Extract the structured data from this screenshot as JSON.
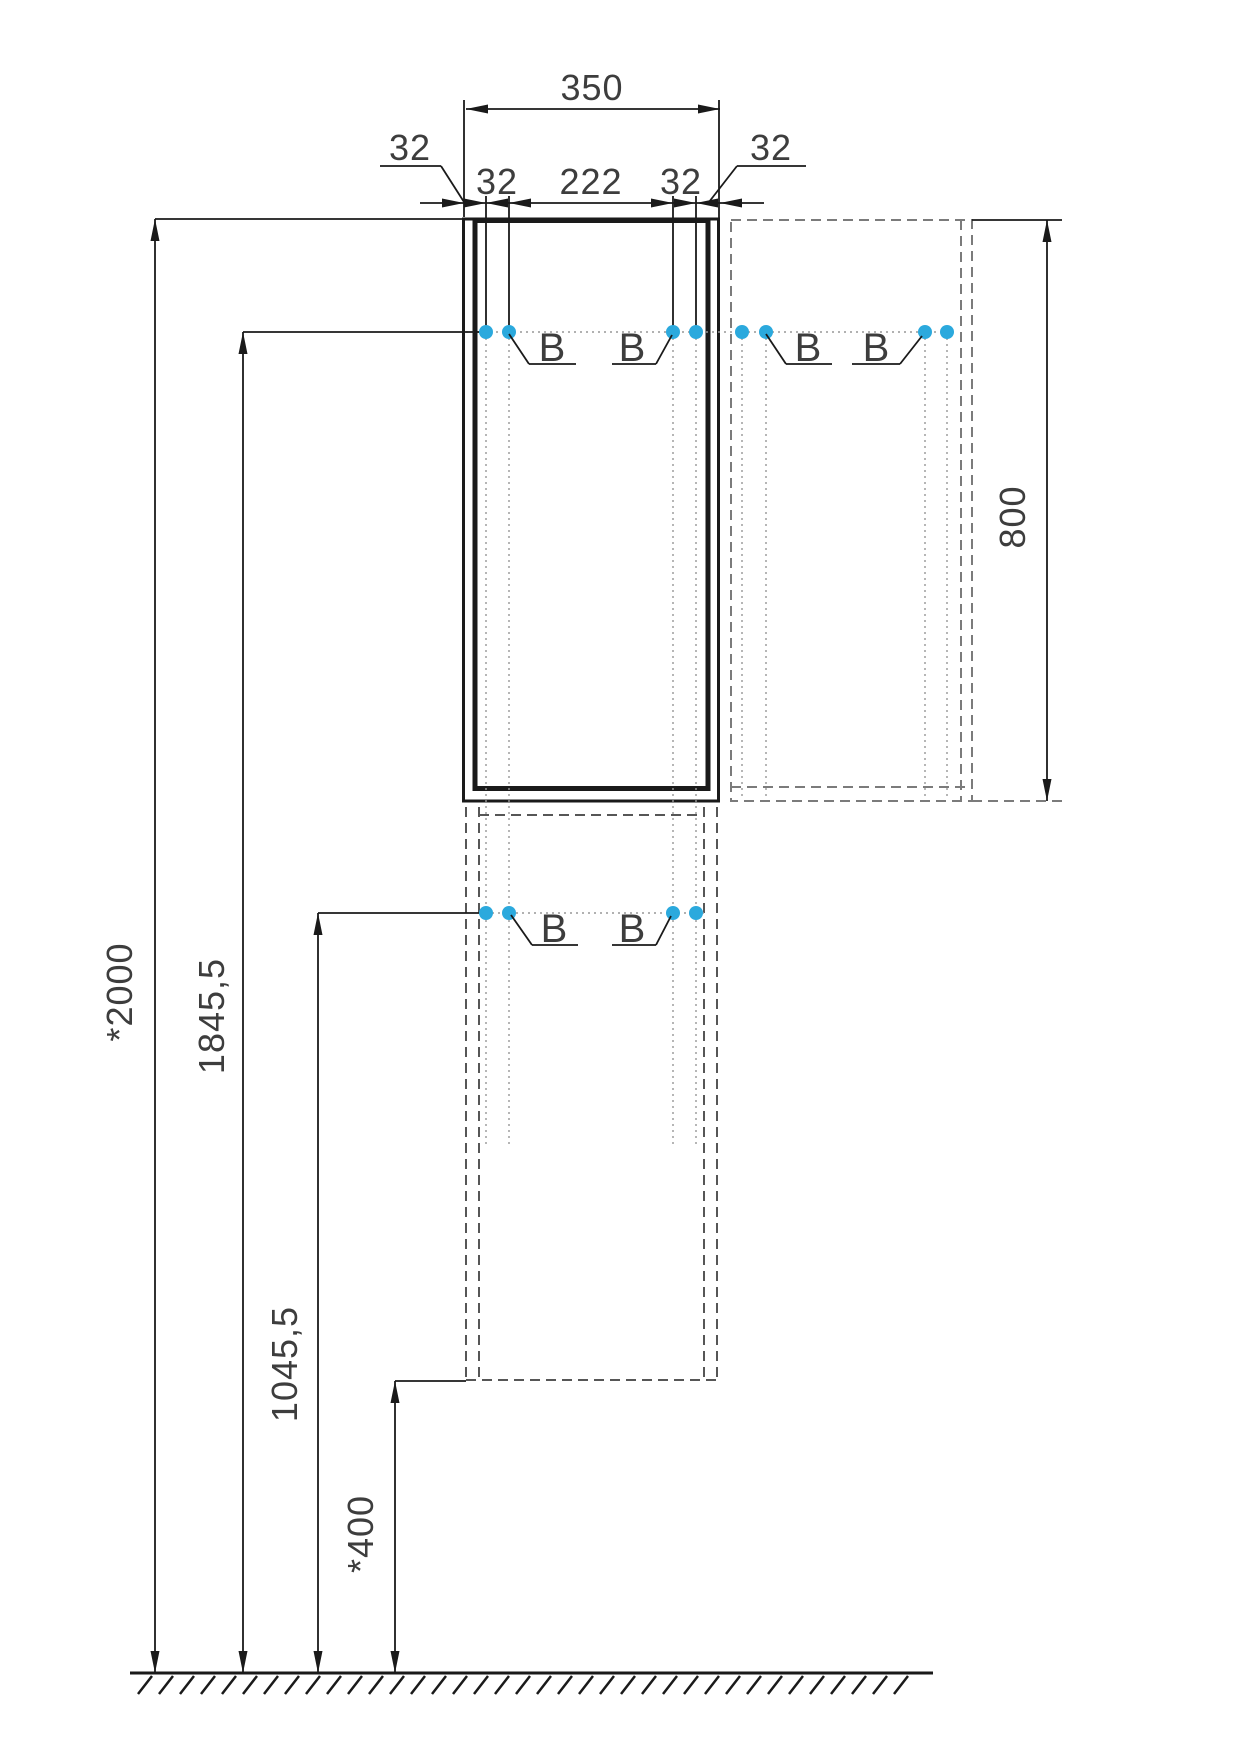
{
  "drawing": {
    "type": "furniture installation dimension drawing",
    "views": {
      "front_view": "tall wall cabinet, upper door section (solid outline)",
      "side_view": "side projection shown dashed at right",
      "lower_section": "lower cabinet section shown dashed below"
    }
  },
  "labels": {
    "width_total": "350",
    "offset_32": "32",
    "span_222": "222",
    "height_total": "*2000",
    "height_upper_mount": "1845,5",
    "height_lower_mount": "1045,5",
    "height_bottom": "*400",
    "side_height": "800",
    "mount_callout": "B"
  },
  "colors": {
    "accent": "#2BA9DD",
    "line": "#1a1a1a",
    "dash": "#565656",
    "dash_light": "#7b7b7b",
    "dotted": "#979797",
    "text": "#3d3d3d"
  },
  "mounting_points": {
    "upper_row_height": "1845,5",
    "lower_row_height": "1045,5",
    "count_upper_row": 8,
    "count_lower_row": 4
  }
}
